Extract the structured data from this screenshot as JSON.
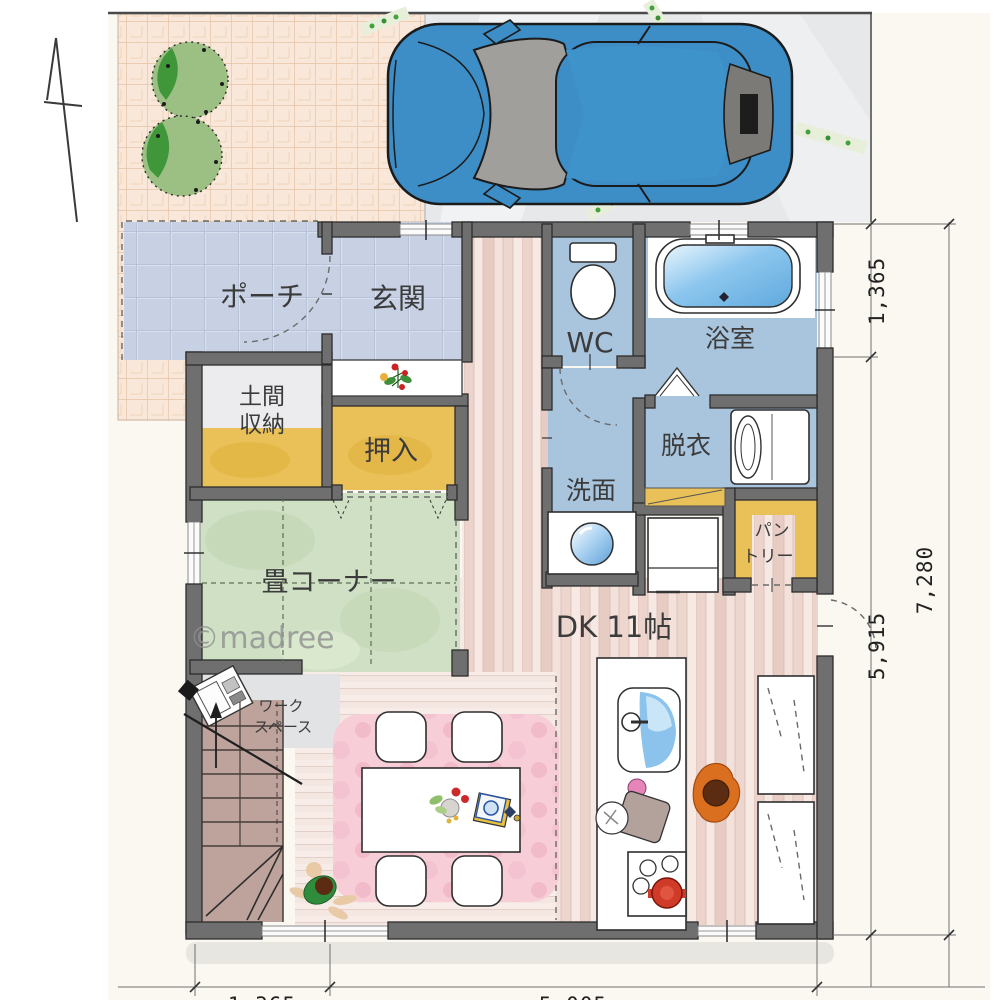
{
  "watermark": {
    "text": "©madree"
  },
  "rooms": {
    "porch": "ポーチ",
    "entrance": "玄関",
    "doma_line1": "土間",
    "doma_line2": "収納",
    "closet": "押入",
    "wc": "WC",
    "bathroom": "浴室",
    "dressing": "脱衣",
    "washroom": "洗面",
    "pantry_line1": "パン",
    "pantry_line2": "トリー",
    "tatami": "畳コーナー",
    "dk": "DK 11帖",
    "workspace_line1": "ワーク",
    "workspace_line2": "スペース"
  },
  "dimensions": {
    "right_top": "1,365",
    "right_bottom": "5,915",
    "right_total": "7,280",
    "bottom_left": "1,365",
    "bottom_right": "5,005"
  },
  "palette": {
    "wall": "#6f6f6f",
    "entry_tile": "#c7d1e3",
    "wet_room_blue": "#a9c4dd",
    "closet_yellow": "#eac158",
    "tatami_green": "#cfe0c4",
    "wood_pink": "#f0dcd6",
    "rug_pink": "#f7ced8",
    "car_blue": "#3d8ec6",
    "tree_green": "#9cc084",
    "water_blue": "#7fc0ec"
  }
}
